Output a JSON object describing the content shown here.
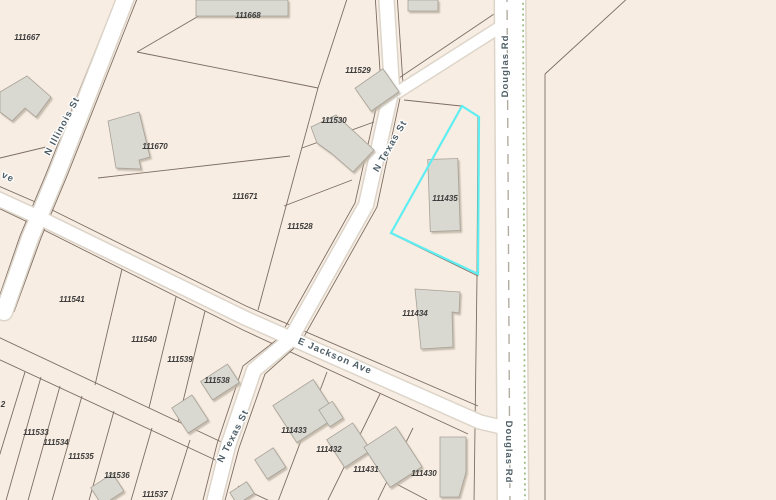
{
  "app": {
    "type": "parcel-map-view"
  },
  "map": {
    "background_color": "#f8ede2",
    "road_color": "#ffffff",
    "parcel_line_color": "#7d6e62",
    "building_color": "#d9d8d1",
    "road_centerline_color": "#b3aca1",
    "boundary_dotted_color": "#9fbc84",
    "highlight": {
      "parcel_id": "111435",
      "color": "#5eeef2"
    },
    "street_labels": [
      {
        "name": "N Illinois St"
      },
      {
        "name": "N Texas St"
      },
      {
        "name": "N Texas St"
      },
      {
        "name": "E Jackson Ave"
      },
      {
        "name": "Douglas Rd"
      },
      {
        "name": "Douglas Rd"
      },
      {
        "name": "ve"
      }
    ],
    "parcel_labels": [
      {
        "id": "111667"
      },
      {
        "id": "111668"
      },
      {
        "id": "111529"
      },
      {
        "id": "111530"
      },
      {
        "id": "111670"
      },
      {
        "id": "111671"
      },
      {
        "id": "111528"
      },
      {
        "id": "111541"
      },
      {
        "id": "111540"
      },
      {
        "id": "111539"
      },
      {
        "id": "111538"
      },
      {
        "id": "111533"
      },
      {
        "id": "111534"
      },
      {
        "id": "111535"
      },
      {
        "id": "111536"
      },
      {
        "id": "111537"
      },
      {
        "id": "111433"
      },
      {
        "id": "111432"
      },
      {
        "id": "111431"
      },
      {
        "id": "111430"
      },
      {
        "id": "111434"
      },
      {
        "id": "111435"
      },
      {
        "id": "2"
      }
    ]
  }
}
